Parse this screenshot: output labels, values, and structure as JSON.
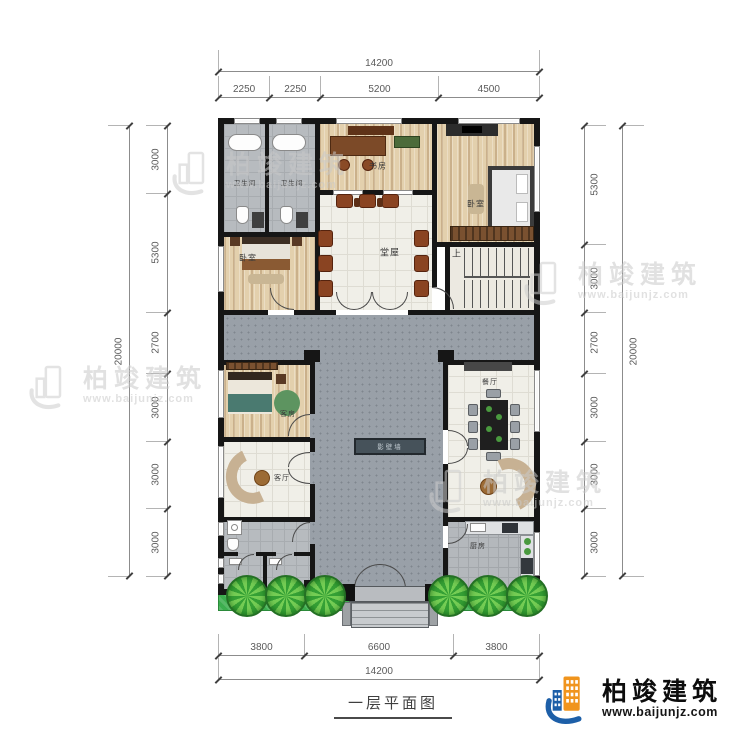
{
  "title": "一层平面图",
  "brand": {
    "name": "柏竣建筑",
    "url": "www.baijunjz.com"
  },
  "rooms": {
    "bath1": "卫生间",
    "bath2": "卫生间",
    "study": "书房",
    "bedroom_right": "卧室",
    "bedroom_left": "卧室",
    "hall": "堂屋",
    "stairs": "上",
    "guest": "客房",
    "living": "客厅",
    "dining": "餐厅",
    "kitchen": "厨房",
    "screen_wall": "影壁墙"
  },
  "dims": {
    "top": {
      "total": [
        "14200"
      ],
      "segments": [
        "2250",
        "2250",
        "5200",
        "4500"
      ]
    },
    "bottom": {
      "total": [
        "14200"
      ],
      "segments": [
        "3800",
        "6600",
        "3800"
      ]
    },
    "left": {
      "total": [
        "20000"
      ],
      "segments": [
        "3000",
        "5300",
        "2700",
        "3000",
        "3000",
        "3000"
      ]
    },
    "right": {
      "total": [
        "20000"
      ],
      "segments": [
        "5300",
        "3000",
        "2700",
        "3000",
        "3000",
        "3000"
      ]
    }
  },
  "colors": {
    "wall": "#161616",
    "courtyard_gray": "#99a0a8",
    "wood": "#e3d0ad",
    "tile": "#f0efe8",
    "hedge_green": "#3cae4e",
    "brand_blue": "#1d5fa8",
    "brand_orange": "#f0941d"
  }
}
